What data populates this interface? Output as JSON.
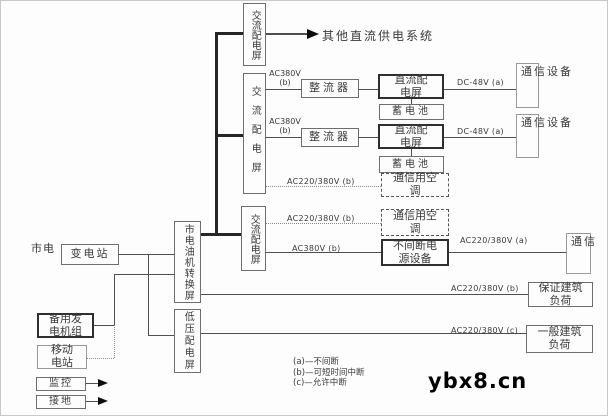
{
  "diagram": {
    "nodes": {
      "mains": "市电",
      "substation": "变电站",
      "transfer_panel": "市电油机转换屏",
      "lv_panel": "低压配电屏",
      "backup_generator": "备用发电机组",
      "mobile_station": "移动电站",
      "monitoring": "监控",
      "grounding": "接地",
      "ac_panel": "交流配电屏",
      "rectifier": "整流器",
      "dc_panel": "直流配电屏",
      "battery": "蓄电池",
      "comm_aircon": "通信用空调",
      "ups": "不间断电源设备",
      "comm_equipment": "通信设备",
      "comm": "通信",
      "guaranteed_load": "保证建筑负荷",
      "general_load": "一般建筑负荷",
      "other_dc_system": "其他直流供电系统"
    },
    "edge_labels": {
      "ac380v": "AC380V",
      "b_paren": "(b)",
      "ac380v_b": "AC380V (b)",
      "ac220_380v_b": "AC220/380V (b)",
      "ac220_380v_a": "AC220/380V (a)",
      "ac220_380v_c": "AC220/380V (c)",
      "dc_48v_a": "DC-48V (a)"
    },
    "legend": {
      "a": "(a)—不间断",
      "b": "(b)—可短时间中断",
      "c": "(c)—允许中断"
    },
    "watermark": "ybx8.cn"
  }
}
